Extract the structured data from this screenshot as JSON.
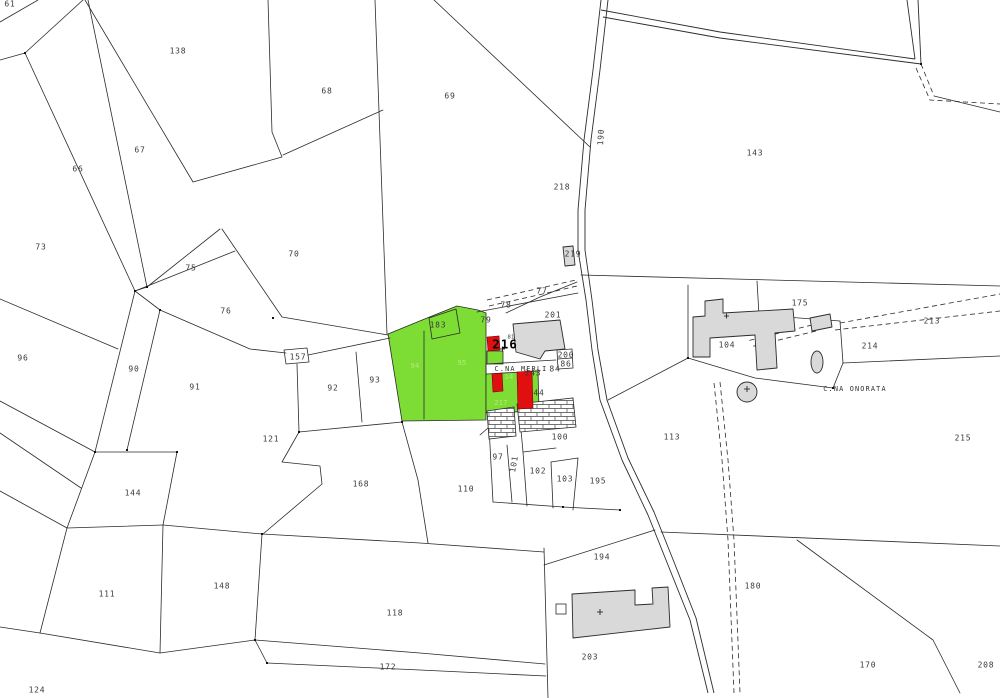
{
  "map": {
    "title_texts": {
      "farm_1": "C.NA MERLI",
      "farm_2": "C.NA ONORATA",
      "highlight_parcel": "216",
      "road_number": "190"
    },
    "colors": {
      "parcel_fill": "#ffffff",
      "highlight_green": "#7ddd35",
      "highlight_red": "#e01010",
      "building_gray": "#d9d9d9",
      "line": "#2b2b2b"
    },
    "labels": [
      {
        "x": 10,
        "y": 4,
        "t": "61",
        "c": "lbl"
      },
      {
        "x": 178,
        "y": 51,
        "t": "138",
        "c": "lbl"
      },
      {
        "x": 327,
        "y": 91,
        "t": "68",
        "c": "lbl"
      },
      {
        "x": 450,
        "y": 96,
        "t": "69",
        "c": "lbl"
      },
      {
        "x": 140,
        "y": 150,
        "t": "67",
        "c": "lbl"
      },
      {
        "x": 78,
        "y": 169,
        "t": "66",
        "c": "lbl"
      },
      {
        "x": 41,
        "y": 247,
        "t": "73",
        "c": "lbl"
      },
      {
        "x": 191,
        "y": 268,
        "t": "75",
        "c": "lbl"
      },
      {
        "x": 294,
        "y": 254,
        "t": "70",
        "c": "lbl"
      },
      {
        "x": 226,
        "y": 311,
        "t": "76",
        "c": "lbl"
      },
      {
        "x": 23,
        "y": 358,
        "t": "96",
        "c": "lbl"
      },
      {
        "x": 134,
        "y": 369,
        "t": "90",
        "c": "lbl"
      },
      {
        "x": 195,
        "y": 387,
        "t": "91",
        "c": "lbl"
      },
      {
        "x": 333,
        "y": 388,
        "t": "92",
        "c": "lbl"
      },
      {
        "x": 375,
        "y": 380,
        "t": "93",
        "c": "lbl"
      },
      {
        "x": 271,
        "y": 439,
        "t": "121",
        "c": "lbl"
      },
      {
        "x": 133,
        "y": 493,
        "t": "144",
        "c": "lbl"
      },
      {
        "x": 107,
        "y": 594,
        "t": "111",
        "c": "lbl"
      },
      {
        "x": 37,
        "y": 690,
        "t": "124",
        "c": "lbl"
      },
      {
        "x": 222,
        "y": 586,
        "t": "148",
        "c": "lbl"
      },
      {
        "x": 361,
        "y": 484,
        "t": "168",
        "c": "lbl"
      },
      {
        "x": 466,
        "y": 489,
        "t": "110",
        "c": "lbl"
      },
      {
        "x": 395,
        "y": 613,
        "t": "118",
        "c": "lbl"
      },
      {
        "x": 388,
        "y": 667,
        "t": "172",
        "c": "lbl"
      },
      {
        "x": 498,
        "y": 457,
        "t": "97",
        "c": "lbl"
      },
      {
        "x": 514,
        "y": 464,
        "t": "101",
        "c": "lbl",
        "r": -80
      },
      {
        "x": 538,
        "y": 471,
        "t": "102",
        "c": "lbl"
      },
      {
        "x": 565,
        "y": 479,
        "t": "103",
        "c": "lbl"
      },
      {
        "x": 560,
        "y": 437,
        "t": "100",
        "c": "lbl"
      },
      {
        "x": 598,
        "y": 481,
        "t": "195",
        "c": "lbl"
      },
      {
        "x": 672,
        "y": 437,
        "t": "113",
        "c": "lbl"
      },
      {
        "x": 602,
        "y": 557,
        "t": "194",
        "c": "lbl"
      },
      {
        "x": 590,
        "y": 657,
        "t": "203",
        "c": "lbl"
      },
      {
        "x": 753,
        "y": 586,
        "t": "180",
        "c": "lbl"
      },
      {
        "x": 868,
        "y": 665,
        "t": "170",
        "c": "lbl"
      },
      {
        "x": 986,
        "y": 665,
        "t": "208",
        "c": "lbl"
      },
      {
        "x": 963,
        "y": 438,
        "t": "215",
        "c": "lbl"
      },
      {
        "x": 870,
        "y": 346,
        "t": "214",
        "c": "lbl"
      },
      {
        "x": 932,
        "y": 321,
        "t": "213",
        "c": "lbl"
      },
      {
        "x": 800,
        "y": 303,
        "t": "175",
        "c": "lbl"
      },
      {
        "x": 727,
        "y": 345,
        "t": "104",
        "c": "lbl"
      },
      {
        "x": 755,
        "y": 153,
        "t": "143",
        "c": "lbl"
      },
      {
        "x": 562,
        "y": 187,
        "t": "218",
        "c": "lbl"
      },
      {
        "x": 573,
        "y": 254,
        "t": "219",
        "c": "lbl"
      },
      {
        "x": 553,
        "y": 315,
        "t": "201",
        "c": "lbl"
      },
      {
        "x": 542,
        "y": 291,
        "t": "77",
        "c": "lbl"
      },
      {
        "x": 506,
        "y": 305,
        "t": "78",
        "c": "lbl"
      },
      {
        "x": 555,
        "y": 369,
        "t": "84",
        "c": "lbl"
      },
      {
        "x": 566,
        "y": 364,
        "t": "86",
        "c": "lbl"
      },
      {
        "x": 566,
        "y": 355,
        "t": "200",
        "c": "lbl"
      },
      {
        "x": 539,
        "y": 393,
        "t": "44",
        "c": "lbl"
      },
      {
        "x": 533,
        "y": 373,
        "t": "243",
        "c": "lbl"
      },
      {
        "x": 298,
        "y": 357,
        "t": "157",
        "c": "lbl"
      },
      {
        "x": 601,
        "y": 137,
        "t": "190",
        "c": "lbl",
        "r": -87
      },
      {
        "x": 511,
        "y": 337,
        "t": "81",
        "c": "sm"
      },
      {
        "x": 438,
        "y": 325,
        "t": "183",
        "c": "lbl"
      },
      {
        "x": 486,
        "y": 320,
        "t": "79",
        "c": "lbl"
      },
      {
        "x": 415,
        "y": 366,
        "t": "94",
        "c": "faint"
      },
      {
        "x": 462,
        "y": 363,
        "t": "95",
        "c": "faint"
      },
      {
        "x": 509,
        "y": 377,
        "t": "14",
        "c": "faint"
      },
      {
        "x": 501,
        "y": 403,
        "t": "217",
        "c": "faint"
      },
      {
        "x": 505,
        "y": 345,
        "t": "216",
        "c": "big"
      },
      {
        "x": 521,
        "y": 369,
        "t": "C.NA MERLI",
        "c": "name"
      },
      {
        "x": 855,
        "y": 389,
        "t": "C.NA ONORATA",
        "c": "name"
      }
    ]
  }
}
